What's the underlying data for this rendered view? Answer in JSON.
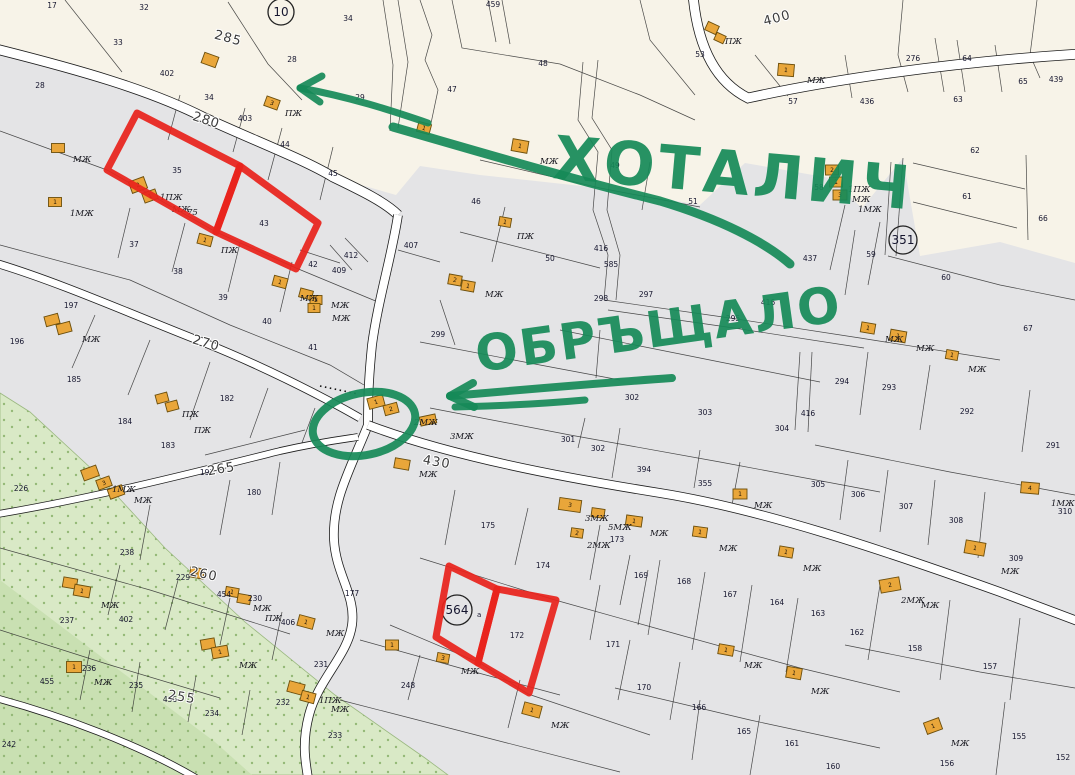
{
  "annotations": {
    "title_top": "ХОТАЛИЧ",
    "title_mid": "ОБРЪЩАЛО",
    "title_top_pos": {
      "x": 552,
      "y": 178,
      "rot": 5,
      "size": 60
    },
    "title_mid_pos": {
      "x": 478,
      "y": 372,
      "rot": -8,
      "size": 50
    }
  },
  "colors": {
    "beige": "#f7f3e8",
    "gray": "#e4e4e6",
    "road_fill": "#ffffff",
    "road_edge": "#1c1c1c",
    "line": "#2c2c2c",
    "building": "#e9a63a",
    "building_edge": "#6b4e0c",
    "veg1": "#d9e9c6",
    "veg2": "#c9e0b2",
    "veg_dot": "#94b877",
    "red": "#e8231c",
    "green": "#168a58",
    "parcel_label": "#15152e",
    "street_label": "#3c3c3c"
  },
  "circled_numbers": [
    [
      "10",
      281,
      12,
      13
    ],
    [
      "351",
      903,
      240,
      14
    ],
    [
      "564",
      457,
      610,
      15
    ]
  ],
  "circled_suffix": {
    "text": "а",
    "x": 477,
    "y": 617
  },
  "street_labels": [
    [
      "285",
      227,
      42,
      15
    ],
    [
      "280",
      205,
      124,
      18
    ],
    [
      "270",
      205,
      347,
      16
    ],
    [
      "265",
      222,
      473,
      -10
    ],
    [
      "260",
      203,
      578,
      12
    ],
    [
      "255",
      181,
      701,
      10
    ],
    [
      "400",
      778,
      22,
      -15
    ],
    [
      "430",
      436,
      466,
      10
    ]
  ],
  "parcel_labels": [
    [
      "17",
      52,
      8
    ],
    [
      "32",
      144,
      10
    ],
    [
      "33",
      118,
      45
    ],
    [
      "402",
      167,
      76
    ],
    [
      "34",
      209,
      100
    ],
    [
      "28",
      40,
      88
    ],
    [
      "403",
      245,
      121
    ],
    [
      "34",
      348,
      21
    ],
    [
      "28",
      292,
      62
    ],
    [
      "29",
      360,
      100
    ],
    [
      "459",
      493,
      7
    ],
    [
      "47",
      452,
      92
    ],
    [
      "48",
      543,
      66
    ],
    [
      "49",
      615,
      168
    ],
    [
      "51",
      693,
      204
    ],
    [
      "53",
      700,
      57
    ],
    [
      "57",
      793,
      104
    ],
    [
      "436",
      867,
      104
    ],
    [
      "276",
      913,
      61
    ],
    [
      "64",
      967,
      61
    ],
    [
      "65",
      1023,
      84
    ],
    [
      "63",
      958,
      102
    ],
    [
      "439",
      1056,
      82
    ],
    [
      "62",
      975,
      153
    ],
    [
      "61",
      967,
      199
    ],
    [
      "66",
      1043,
      221
    ],
    [
      "35",
      177,
      173
    ],
    [
      "43",
      264,
      226
    ],
    [
      "44",
      285,
      147
    ],
    [
      "45",
      333,
      176
    ],
    [
      "37",
      134,
      247
    ],
    [
      "38",
      178,
      274
    ],
    [
      "39",
      223,
      300
    ],
    [
      "40",
      267,
      324
    ],
    [
      "41",
      313,
      350
    ],
    [
      "42",
      313,
      267
    ],
    [
      "412",
      351,
      258
    ],
    [
      "409",
      339,
      273
    ],
    [
      "407",
      411,
      248
    ],
    [
      "46",
      476,
      204
    ],
    [
      "50",
      550,
      261
    ],
    [
      "416",
      601,
      251
    ],
    [
      "585",
      611,
      267
    ],
    [
      "298",
      601,
      301
    ],
    [
      "297",
      646,
      297
    ],
    [
      "295",
      733,
      321
    ],
    [
      "416",
      768,
      305
    ],
    [
      "299",
      438,
      337
    ],
    [
      "58",
      819,
      190
    ],
    [
      "437",
      810,
      261
    ],
    [
      "59",
      871,
      257
    ],
    [
      "60",
      946,
      280
    ],
    [
      "67",
      1028,
      331
    ],
    [
      "197",
      71,
      308
    ],
    [
      "196",
      17,
      344
    ],
    [
      "185",
      74,
      382
    ],
    [
      "184",
      125,
      424
    ],
    [
      "183",
      168,
      448
    ],
    [
      "182",
      227,
      401
    ],
    [
      "226",
      21,
      491
    ],
    [
      "180",
      254,
      495
    ],
    [
      "191",
      207,
      475
    ],
    [
      "301",
      568,
      442
    ],
    [
      "302",
      632,
      400
    ],
    [
      "302",
      598,
      451
    ],
    [
      "394",
      644,
      472
    ],
    [
      "355",
      705,
      486
    ],
    [
      "303",
      705,
      415
    ],
    [
      "304",
      782,
      431
    ],
    [
      "416",
      808,
      416
    ],
    [
      "294",
      842,
      384
    ],
    [
      "293",
      889,
      390
    ],
    [
      "292",
      967,
      414
    ],
    [
      "291",
      1053,
      448
    ],
    [
      "305",
      818,
      487
    ],
    [
      "306",
      858,
      497
    ],
    [
      "307",
      906,
      509
    ],
    [
      "308",
      956,
      523
    ],
    [
      "310",
      1065,
      514
    ],
    [
      "309",
      1016,
      561
    ],
    [
      "175",
      488,
      528
    ],
    [
      "174",
      543,
      568
    ],
    [
      "173",
      617,
      542
    ],
    [
      "177",
      352,
      596
    ],
    [
      "172",
      517,
      638
    ],
    [
      "171",
      613,
      647
    ],
    [
      "170",
      644,
      690
    ],
    [
      "169",
      641,
      578
    ],
    [
      "168",
      684,
      584
    ],
    [
      "167",
      730,
      597
    ],
    [
      "164",
      777,
      605
    ],
    [
      "163",
      818,
      616
    ],
    [
      "162",
      857,
      635
    ],
    [
      "158",
      915,
      651
    ],
    [
      "157",
      990,
      669
    ],
    [
      "166",
      699,
      710
    ],
    [
      "165",
      744,
      734
    ],
    [
      "161",
      792,
      746
    ],
    [
      "160",
      833,
      769
    ],
    [
      "156",
      947,
      766
    ],
    [
      "155",
      1019,
      739
    ],
    [
      "152",
      1063,
      760
    ],
    [
      "238",
      127,
      555
    ],
    [
      "229",
      183,
      580
    ],
    [
      "237",
      67,
      623
    ],
    [
      "402",
      126,
      622
    ],
    [
      "454",
      224,
      597
    ],
    [
      "230",
      255,
      601
    ],
    [
      "406",
      288,
      625
    ],
    [
      "236",
      89,
      671
    ],
    [
      "455",
      47,
      684
    ],
    [
      "235",
      136,
      688
    ],
    [
      "234",
      212,
      716
    ],
    [
      "232",
      283,
      705
    ],
    [
      "233",
      335,
      738
    ],
    [
      "242",
      9,
      747
    ],
    [
      "231",
      321,
      667
    ],
    [
      "248",
      408,
      688
    ],
    [
      "456",
      170,
      702
    ]
  ],
  "building_labels": [
    [
      "ПЖ",
      285,
      116
    ],
    [
      "МЖ",
      807,
      83
    ],
    [
      "ПЖ",
      725,
      44
    ],
    [
      "1ПЖ",
      848,
      192
    ],
    [
      "МЖ",
      852,
      202
    ],
    [
      "1МЖ",
      858,
      212
    ],
    [
      "МЖ",
      540,
      164
    ],
    [
      "ПЖ",
      517,
      239
    ],
    [
      "МЖ",
      485,
      297
    ],
    [
      "МЖ",
      300,
      301
    ],
    [
      "МЖ",
      331,
      308
    ],
    [
      "ПЖ",
      221,
      253
    ],
    [
      "1ПЖ",
      160,
      200
    ],
    [
      "МЖ",
      172,
      212
    ],
    [
      "75",
      187,
      215
    ],
    [
      "МЖ",
      73,
      162
    ],
    [
      "1МЖ",
      70,
      216
    ],
    [
      "МЖ",
      82,
      342
    ],
    [
      "ПЖ",
      182,
      417
    ],
    [
      "ПЖ",
      194,
      433
    ],
    [
      "1МЖ",
      112,
      492
    ],
    [
      "МЖ",
      134,
      503
    ],
    [
      "МЖ",
      332,
      321
    ],
    [
      "2МЖ",
      414,
      425
    ],
    [
      "3МЖ",
      450,
      439
    ],
    [
      "МЖ",
      419,
      477
    ],
    [
      "3МЖ",
      585,
      521
    ],
    [
      "5МЖ",
      608,
      530
    ],
    [
      "МЖ",
      650,
      536
    ],
    [
      "МЖ",
      719,
      551
    ],
    [
      "2МЖ",
      587,
      548
    ],
    [
      "МЖ",
      754,
      508
    ],
    [
      "МЖ",
      885,
      342
    ],
    [
      "МЖ",
      916,
      351
    ],
    [
      "МЖ",
      968,
      372
    ],
    [
      "1МЖ",
      1051,
      506
    ],
    [
      "МЖ",
      1001,
      574
    ],
    [
      "МЖ",
      803,
      571
    ],
    [
      "2МЖ",
      901,
      603
    ],
    [
      "МЖ",
      921,
      608
    ],
    [
      "МЖ",
      744,
      668
    ],
    [
      "МЖ",
      811,
      694
    ],
    [
      "МЖ",
      951,
      746
    ],
    [
      "МЖ",
      326,
      636
    ],
    [
      "МЖ",
      461,
      674
    ],
    [
      "1ПЖ",
      319,
      703
    ],
    [
      "МЖ",
      331,
      712
    ],
    [
      "МЖ",
      101,
      608
    ],
    [
      "МЖ",
      253,
      611
    ],
    [
      "ПЖ",
      265,
      621
    ],
    [
      "МЖ",
      94,
      685
    ],
    [
      "МЖ",
      239,
      668
    ],
    [
      "МЖ",
      551,
      728
    ]
  ],
  "buildings": [
    [
      210,
      60,
      15,
      11,
      20,
      ""
    ],
    [
      272,
      103,
      14,
      10,
      20,
      "3"
    ],
    [
      424,
      128,
      13,
      10,
      15,
      "1"
    ],
    [
      520,
      146,
      16,
      12,
      10,
      "1"
    ],
    [
      786,
      70,
      16,
      12,
      5,
      "1"
    ],
    [
      712,
      28,
      12,
      9,
      25,
      ""
    ],
    [
      720,
      38,
      10,
      8,
      25,
      ""
    ],
    [
      832,
      170,
      13,
      10,
      0,
      "2"
    ],
    [
      836,
      182,
      13,
      10,
      0,
      "1"
    ],
    [
      840,
      195,
      14,
      10,
      0,
      "3"
    ],
    [
      58,
      148,
      13,
      9,
      0,
      ""
    ],
    [
      55,
      202,
      13,
      9,
      0,
      "1"
    ],
    [
      52,
      320,
      14,
      10,
      -15,
      ""
    ],
    [
      64,
      328,
      14,
      10,
      -15,
      ""
    ],
    [
      138,
      185,
      16,
      12,
      -20,
      "2"
    ],
    [
      150,
      196,
      14,
      10,
      -20,
      "1"
    ],
    [
      205,
      240,
      14,
      10,
      15,
      "1"
    ],
    [
      280,
      282,
      14,
      10,
      15,
      "1"
    ],
    [
      306,
      294,
      13,
      9,
      15,
      ""
    ],
    [
      316,
      300,
      12,
      9,
      0,
      "2"
    ],
    [
      314,
      308,
      12,
      9,
      0,
      "1"
    ],
    [
      505,
      222,
      12,
      9,
      10,
      "1"
    ],
    [
      455,
      280,
      13,
      10,
      10,
      "2"
    ],
    [
      468,
      286,
      13,
      10,
      10,
      "1"
    ],
    [
      162,
      398,
      12,
      9,
      -15,
      ""
    ],
    [
      172,
      406,
      12,
      9,
      -15,
      ""
    ],
    [
      90,
      473,
      16,
      11,
      -20,
      ""
    ],
    [
      104,
      483,
      14,
      10,
      -20,
      "3"
    ],
    [
      116,
      492,
      15,
      10,
      -20,
      ""
    ],
    [
      376,
      402,
      16,
      11,
      -15,
      "1"
    ],
    [
      391,
      409,
      14,
      10,
      -15,
      "2"
    ],
    [
      428,
      420,
      16,
      9,
      -12,
      ""
    ],
    [
      402,
      464,
      15,
      10,
      10,
      ""
    ],
    [
      570,
      505,
      22,
      12,
      8,
      "3"
    ],
    [
      598,
      513,
      13,
      9,
      8,
      ""
    ],
    [
      634,
      521,
      16,
      10,
      8,
      "1"
    ],
    [
      700,
      532,
      14,
      10,
      8,
      "1"
    ],
    [
      577,
      533,
      12,
      9,
      8,
      "2"
    ],
    [
      740,
      494,
      14,
      10,
      0,
      "1"
    ],
    [
      868,
      328,
      14,
      10,
      10,
      "1"
    ],
    [
      898,
      336,
      16,
      11,
      10,
      "1"
    ],
    [
      952,
      355,
      12,
      9,
      10,
      "1"
    ],
    [
      1030,
      488,
      18,
      11,
      5,
      "4"
    ],
    [
      975,
      548,
      20,
      13,
      10,
      "1"
    ],
    [
      786,
      552,
      14,
      10,
      10,
      "1"
    ],
    [
      890,
      585,
      20,
      13,
      -10,
      "2"
    ],
    [
      726,
      650,
      15,
      10,
      10,
      "1"
    ],
    [
      794,
      673,
      15,
      11,
      10,
      "1"
    ],
    [
      933,
      726,
      16,
      12,
      -20,
      "1"
    ],
    [
      306,
      622,
      16,
      11,
      15,
      "1"
    ],
    [
      392,
      645,
      13,
      10,
      0,
      "1"
    ],
    [
      443,
      658,
      12,
      9,
      10,
      "3"
    ],
    [
      296,
      688,
      16,
      11,
      15,
      ""
    ],
    [
      308,
      697,
      14,
      10,
      15,
      "1"
    ],
    [
      532,
      710,
      18,
      12,
      15,
      "1"
    ],
    [
      70,
      583,
      14,
      10,
      10,
      ""
    ],
    [
      82,
      591,
      16,
      11,
      10,
      "1"
    ],
    [
      197,
      573,
      14,
      10,
      10,
      "1"
    ],
    [
      232,
      592,
      13,
      9,
      10,
      "1"
    ],
    [
      244,
      599,
      13,
      9,
      10,
      ""
    ],
    [
      74,
      667,
      15,
      11,
      0,
      "1"
    ],
    [
      208,
      644,
      14,
      10,
      -10,
      ""
    ],
    [
      220,
      652,
      16,
      11,
      -10,
      "1"
    ]
  ],
  "geometry": {
    "beige": "M0,0 H1075 V263 L1000,242 L920,256 L903,158 L862,208 L830,178 L745,163 L700,205 L600,188 L480,175 L420,166 L396,195 L333,177 L280,148 L205,118 L150,90 L0,53 Z",
    "veg1": "M0,393 L30,412 L95,472 L165,548 L245,622 L335,695 L425,758 L448,775 L0,775 Z",
    "veg2": "M0,580 L95,652 L215,742 L252,775 L0,775 Z",
    "roads": [
      [
        "M-8,48 C80,70 150,90 205,118 C260,143 305,160 333,177 C360,190 385,202 398,215",
        9
      ],
      [
        "M398,215 C392,255 378,300 372,345 C368,385 368,405 368,425 C350,470 332,500 334,540 C336,575 356,595 352,625 C348,655 318,680 309,715 C302,742 305,760 308,778",
        8
      ],
      [
        "M368,425 C450,456 560,477 660,493 C760,509 880,549 1000,592 L1080,622",
        8
      ],
      [
        "M-8,262 C60,282 140,318 205,343 C260,365 320,395 360,418",
        7
      ],
      [
        "M-8,515 C90,499 200,471 280,451 C320,442 345,439 358,437",
        6
      ],
      [
        "M-8,697 C60,715 140,745 196,778",
        6
      ],
      [
        "M693,-5 C697,40 712,80 748,98 C830,80 950,62 1080,54",
        9
      ]
    ],
    "dotted": "M320,386 L358,394",
    "lines": [
      "M0,131 L107,170 L216,232 L296,268 L378,302",
      "M0,245 L130,280 L230,325 L330,365 L364,385",
      "M130,208 L118,258",
      "M185,223 L172,272",
      "M240,243 L228,292",
      "M292,262 L280,312",
      "M333,147 L320,200",
      "M282,128 L268,180",
      "M245,108 L233,152",
      "M180,95 L168,140",
      "M95,315 L72,368",
      "M150,340 L128,395",
      "M210,362 L190,420",
      "M268,388 L250,438",
      "M315,408 L300,448",
      "M150,505 L140,560",
      "M230,480 L220,535",
      "M280,462 L272,515",
      "M0,548 L150,590 L290,634",
      "M120,565 L108,615",
      "M178,580 L165,630",
      "M230,598 L220,645",
      "M282,612 L272,660",
      "M0,630 L110,665 L220,698",
      "M90,650 L80,700",
      "M140,662 L132,712",
      "M196,676 L188,722",
      "M250,690 L242,735",
      "M360,640 L460,668 L560,695",
      "M340,700 L480,736 L620,772",
      "M420,655 L408,700",
      "M520,680 L508,728",
      "M420,558 L555,600 L680,635 L800,668 L900,692",
      "M390,625 L480,663 L528,694 L650,735",
      "M455,490 L445,545",
      "M528,508 L515,565",
      "M600,525 L590,580",
      "M630,555 L620,605",
      "M600,585 L590,640",
      "M648,570 L638,625",
      "M660,560 L648,635",
      "M705,572 L692,650",
      "M752,585 L740,662",
      "M798,598 L786,672",
      "M615,688 L750,720 L880,748",
      "M700,700 L692,760",
      "M760,715 L750,775",
      "M845,645 L980,672 L1075,688",
      "M880,585 L868,660",
      "M950,600 L940,680",
      "M1020,618 L1010,700",
      "M1005,702 L996,775",
      "M630,640 L618,700",
      "M680,662 L670,720",
      "M430,408 L570,435 L720,462 L880,492",
      "M585,418 L578,448",
      "M620,428 L612,478",
      "M700,450 L694,488",
      "M740,462 L732,505",
      "M560,330 L700,358 L820,382",
      "M604,300 L730,318 L860,338 L1000,360",
      "M608,310 L734,328 L864,348",
      "M800,352 L795,430",
      "M812,352 L808,432",
      "M868,352 L860,415",
      "M930,365 L920,430",
      "M1030,390 L1022,452",
      "M815,445 L950,472 L1075,495",
      "M848,460 L840,520",
      "M888,470 L880,532",
      "M935,480 L928,545",
      "M985,492 L978,558",
      "M460,232 L600,268",
      "M505,207 L492,262",
      "M650,162 L642,210",
      "M583,62 L578,120 L598,152 L593,210 L608,255 L604,300",
      "M598,60 L592,118 L612,150 L607,210 L620,255 L616,300",
      "M65,0 L122,72",
      "M228,2 L268,64 L302,100",
      "M383,0 L393,65 L390,131",
      "M398,0 L408,62 L398,128",
      "M452,0 L462,48 L560,64",
      "M903,0 L898,55 L908,92",
      "M1037,0 L1030,55 L1040,78",
      "M957,40 L965,92",
      "M913,163 L1025,189",
      "M913,202 L1017,228",
      "M1026,155 L1028,240",
      "M891,162 L885,255",
      "M903,158 L896,256",
      "M845,205 L830,270",
      "M880,222 L868,285",
      "M888,256 L1000,285 L1075,300",
      "M855,230 L845,295",
      "M480,160 L600,188 L700,207",
      "M420,342 L540,365 L620,380",
      "M440,300 L455,345",
      "M398,250 L440,262",
      "M300,250 L340,263",
      "M330,245 L352,270",
      "M345,238 L368,262",
      "M205,455 L305,430",
      "M600,330 L596,378",
      "M420,0 L432,35 L425,60 L438,90 L430,128",
      "M488,0 L496,42",
      "M502,0 L510,44",
      "M560,64 L640,95 L695,120",
      "M640,0 L650,40 L695,95",
      "M755,55 L788,96",
      "M845,55 L852,98",
      "M935,38 L944,92",
      "M995,45 L1002,92"
    ],
    "red_marks": [
      "M137,113 L240,166 L216,232 L107,170 Z",
      "M240,166 L318,223 L296,269 L216,232 Z",
      "M449,566 L497,589 L478,663 L436,637 Z",
      "M497,589 L556,600 L529,693 L478,663 Z"
    ],
    "green_paths": [
      [
        "M300,88 C350,97 390,110 428,123",
        7
      ],
      [
        "M300,88 L322,76",
        7
      ],
      [
        "M300,88 L320,102",
        7
      ],
      [
        "M393,127 C480,152 560,176 660,201 C720,219 765,242 790,264",
        9
      ],
      [
        "M672,378 C600,383 520,390 450,396",
        8
      ],
      [
        "M450,396 L473,383",
        8
      ],
      [
        "M450,396 L474,407",
        8
      ],
      [
        "M585,400 C540,404 500,406 455,407",
        7
      ]
    ],
    "green_ellipse": {
      "cx": 364,
      "cy": 424,
      "rx": 52,
      "ry": 31,
      "rot": -12,
      "w": 8
    }
  }
}
